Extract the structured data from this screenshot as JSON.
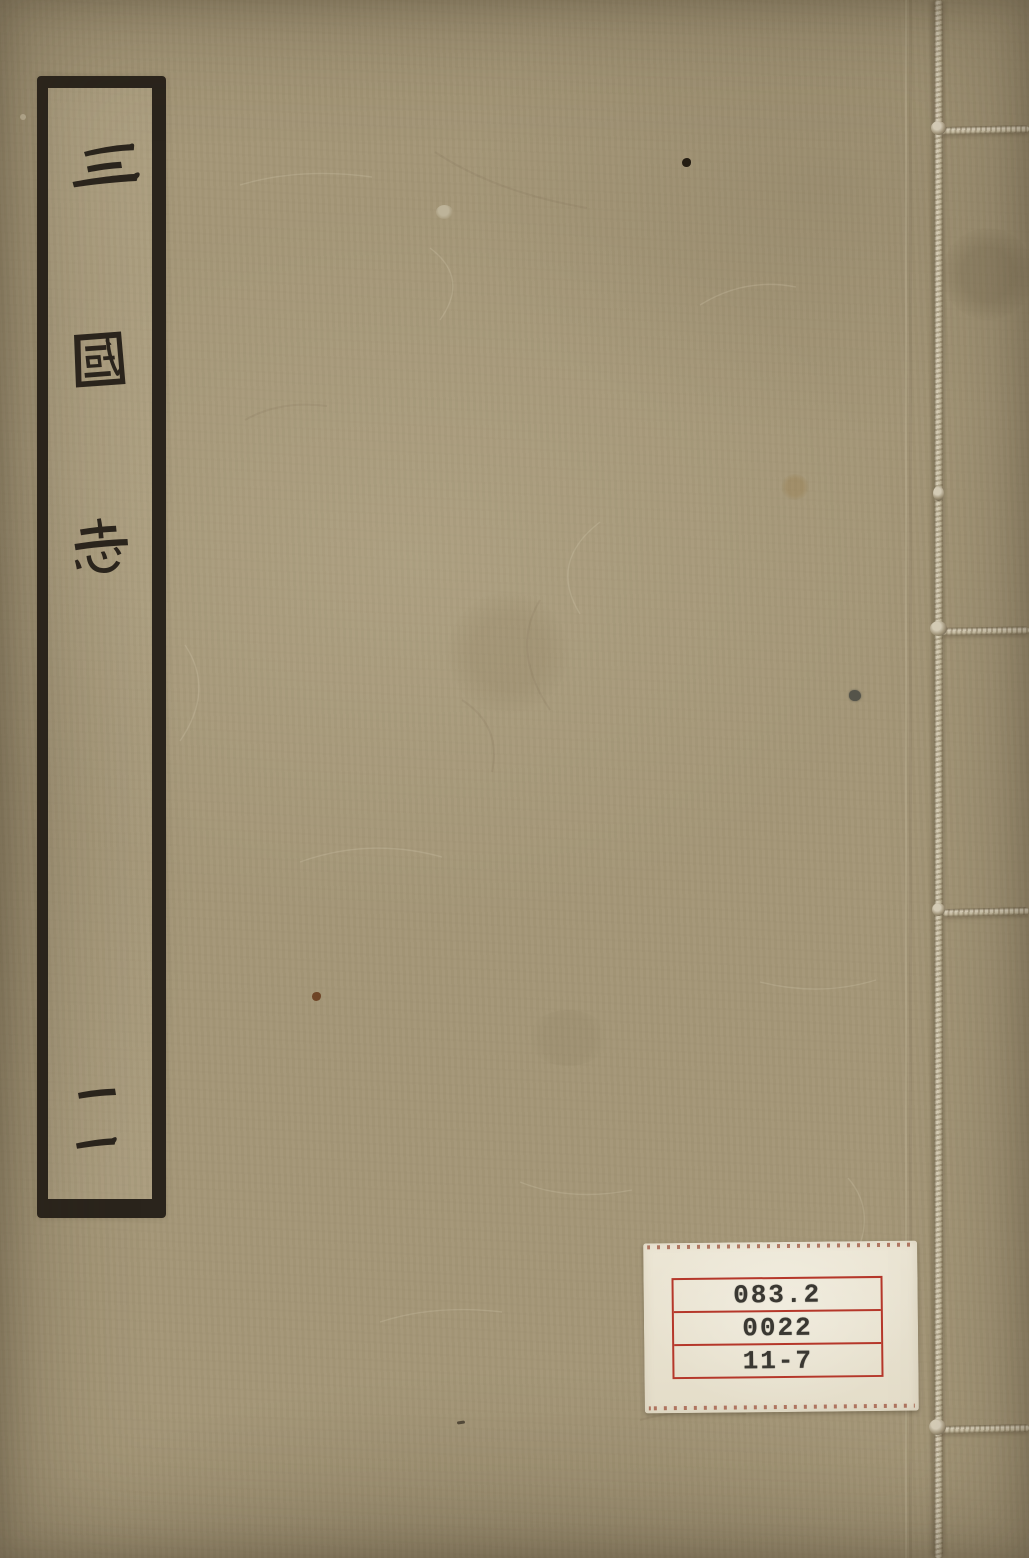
{
  "cover": {
    "title": "三國志",
    "title_chars": [
      "三",
      "國",
      "志"
    ],
    "volume_label": "二",
    "base_color": "#a49677",
    "ink_color": "#2b251d",
    "label_border_color": "#2a241c"
  },
  "library_label": {
    "lines": [
      "083.2",
      "0022",
      "11-7"
    ],
    "background_color": "#ece6d5",
    "rule_color": "#b5372a",
    "text_color": "#3a3832"
  },
  "binding": {
    "thread_color": "#d6cdb6",
    "stitch_count": "4"
  }
}
